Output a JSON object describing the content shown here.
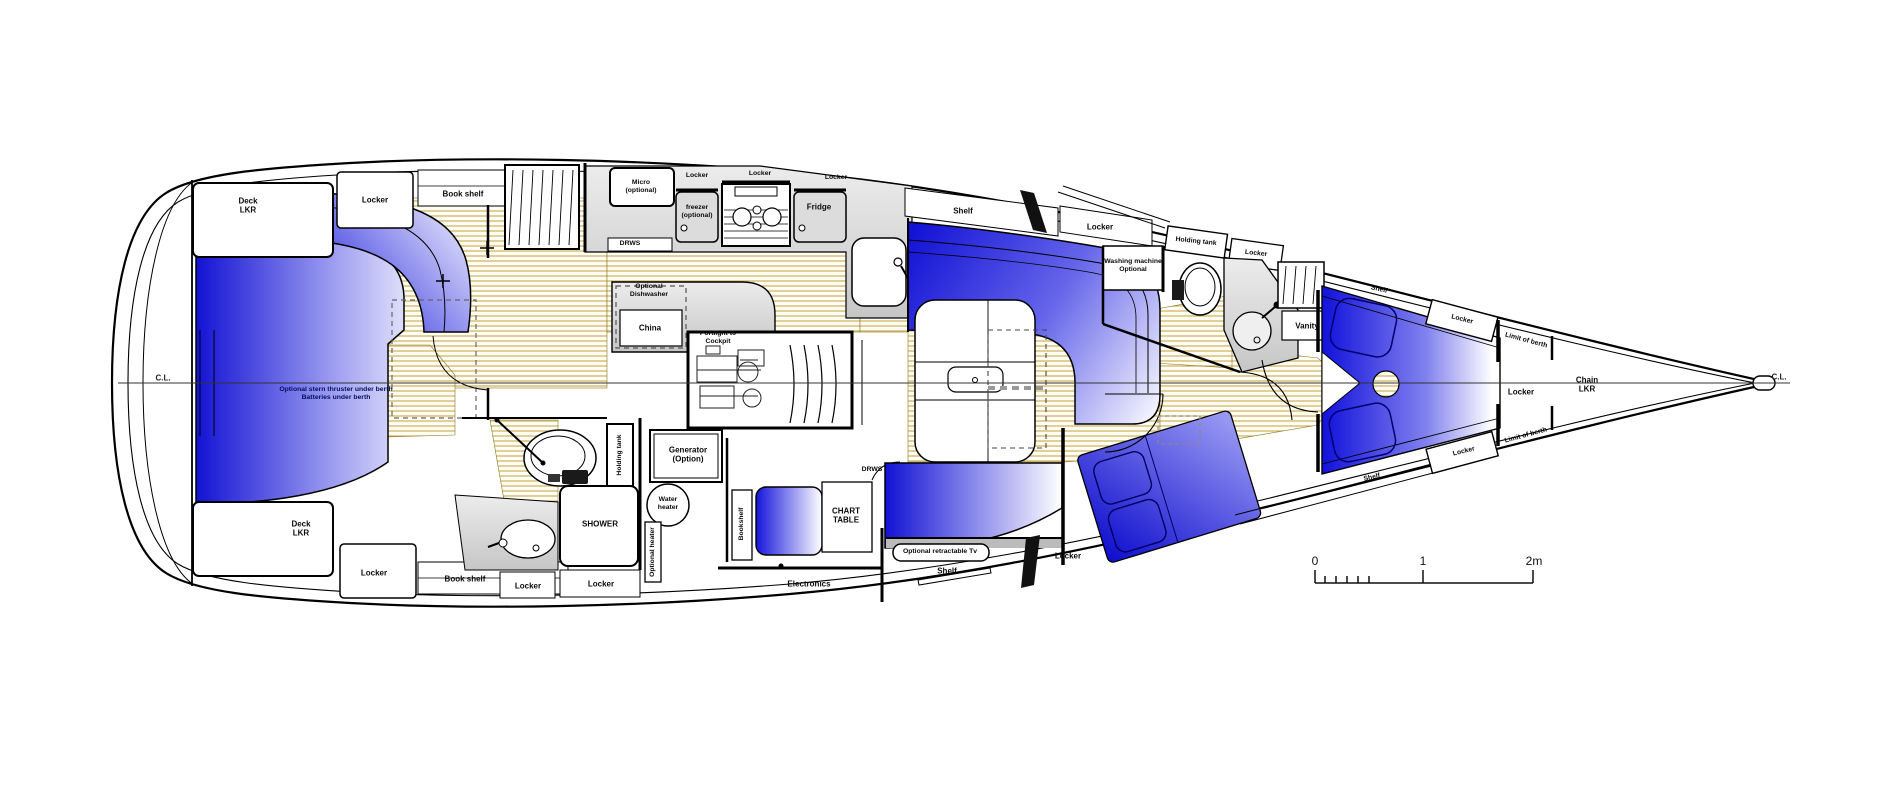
{
  "diagram": {
    "type": "sailing-yacht-interior-deck-plan",
    "colors": {
      "berth_blue": "#1313d6",
      "floor_line": "#c9a84c",
      "furniture_gray": "#d6d6d6"
    },
    "centerline": {
      "left": "C.L.",
      "right": "C.L."
    },
    "scale_bar": {
      "tick0": "0",
      "tick1": "1",
      "tick2": "2m"
    }
  },
  "labels": {
    "stern": {
      "deck_lkr_top": "Deck\nLKR",
      "locker_top": "Locker",
      "book_shelf_top": "Book shelf",
      "berth_note": "Optional stern thruster under berth\nBatteries under berth",
      "deck_lkr_bottom": "Deck\nLKR",
      "locker_bottom": "Locker",
      "book_shelf_bottom": "Book shelf"
    },
    "galley": {
      "micro": "Micro\n(optional)",
      "locker_1": "Locker",
      "locker_2": "Locker",
      "locker_3": "Locker",
      "freezer": "freezer\n(optional)",
      "fridge": "Fridge",
      "drws": "DRWS",
      "dishwasher": "Optional\nDishwasher",
      "china": "China",
      "portlight": "Portlight to\nCockpit"
    },
    "aft_head": {
      "holding_tank": "Holding tank",
      "shower": "SHOWER",
      "locker_1": "Locker",
      "locker_2": "Locker"
    },
    "systems": {
      "water_heater": "Water\nheater",
      "optional_heater": "Optional heater",
      "generator": "Generator\n(Option)"
    },
    "nav": {
      "bookshelf": "Bookshelf",
      "chart_table": "CHART\nTABLE",
      "drws": "DRWS",
      "electronics": "Electronics",
      "tv": "Optional retractable Tv",
      "shelf": "Shelf",
      "locker": "Locker"
    },
    "saloon": {
      "shelf": "Shelf",
      "locker": "Locker"
    },
    "fwd_head": {
      "washing_machine": "Washing machine\nOptional",
      "holding_tank": "Holding tank",
      "locker": "Locker",
      "vanity": "Vanity"
    },
    "fwd_cabin": {
      "shelf_top": "Shelf",
      "locker_top": "Locker",
      "limit_top": "Limit of berth",
      "locker_center": "Locker",
      "chain_lkr": "Chain\nLKR",
      "limit_bottom": "Limit of berth",
      "locker_bottom": "Locker",
      "shelf_bottom": "Shelf"
    }
  }
}
